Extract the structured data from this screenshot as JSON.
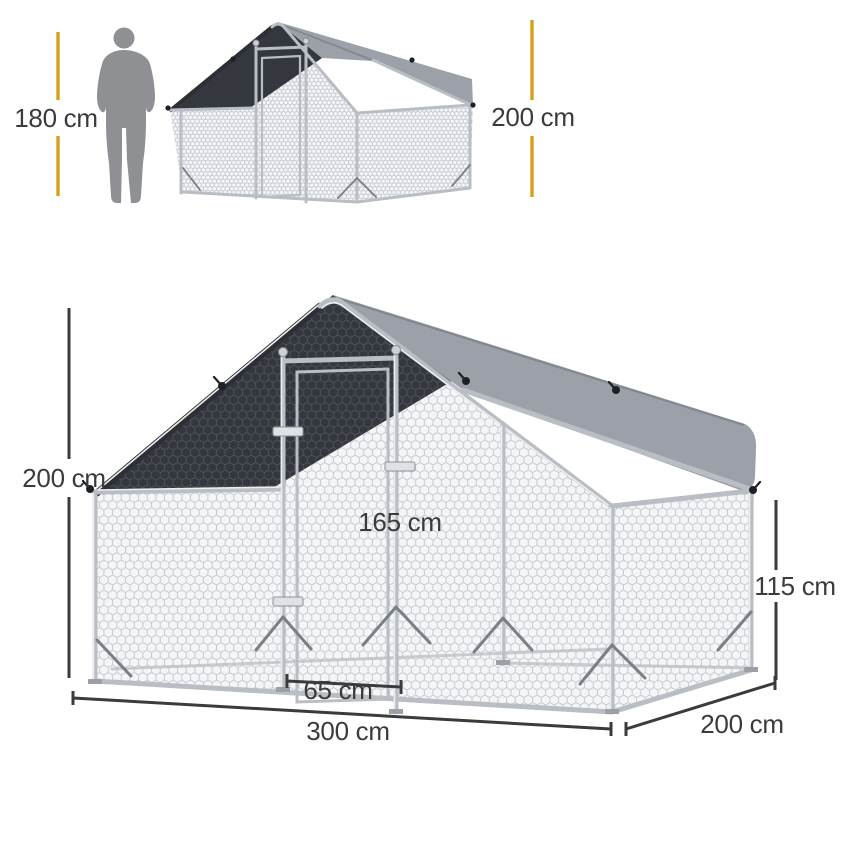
{
  "scale_figure": {
    "human_height_label": "180 cm",
    "coop_height_label": "200 cm"
  },
  "main_figure": {
    "peak_height_label": "200 cm",
    "door_height_label": "165 cm",
    "side_wall_height_label": "115 cm",
    "door_width_label": "65 cm",
    "length_label": "300 cm",
    "depth_label": "200 cm"
  },
  "icons": {
    "human_silhouette": "standing-person-silhouette"
  },
  "colors": {
    "dimension_gold": "#D4A01E",
    "dimension_dark": "#3B3B3B",
    "tarp_dark": "#34373E",
    "tarp_gray": "#9CA0A9",
    "frame_silver": "#B9BEC4",
    "frame_dark": "#2C2F34",
    "mesh_line": "#C7CBD1",
    "mesh_line_dark": "#4C5058",
    "silhouette_gray": "#8E9093"
  }
}
